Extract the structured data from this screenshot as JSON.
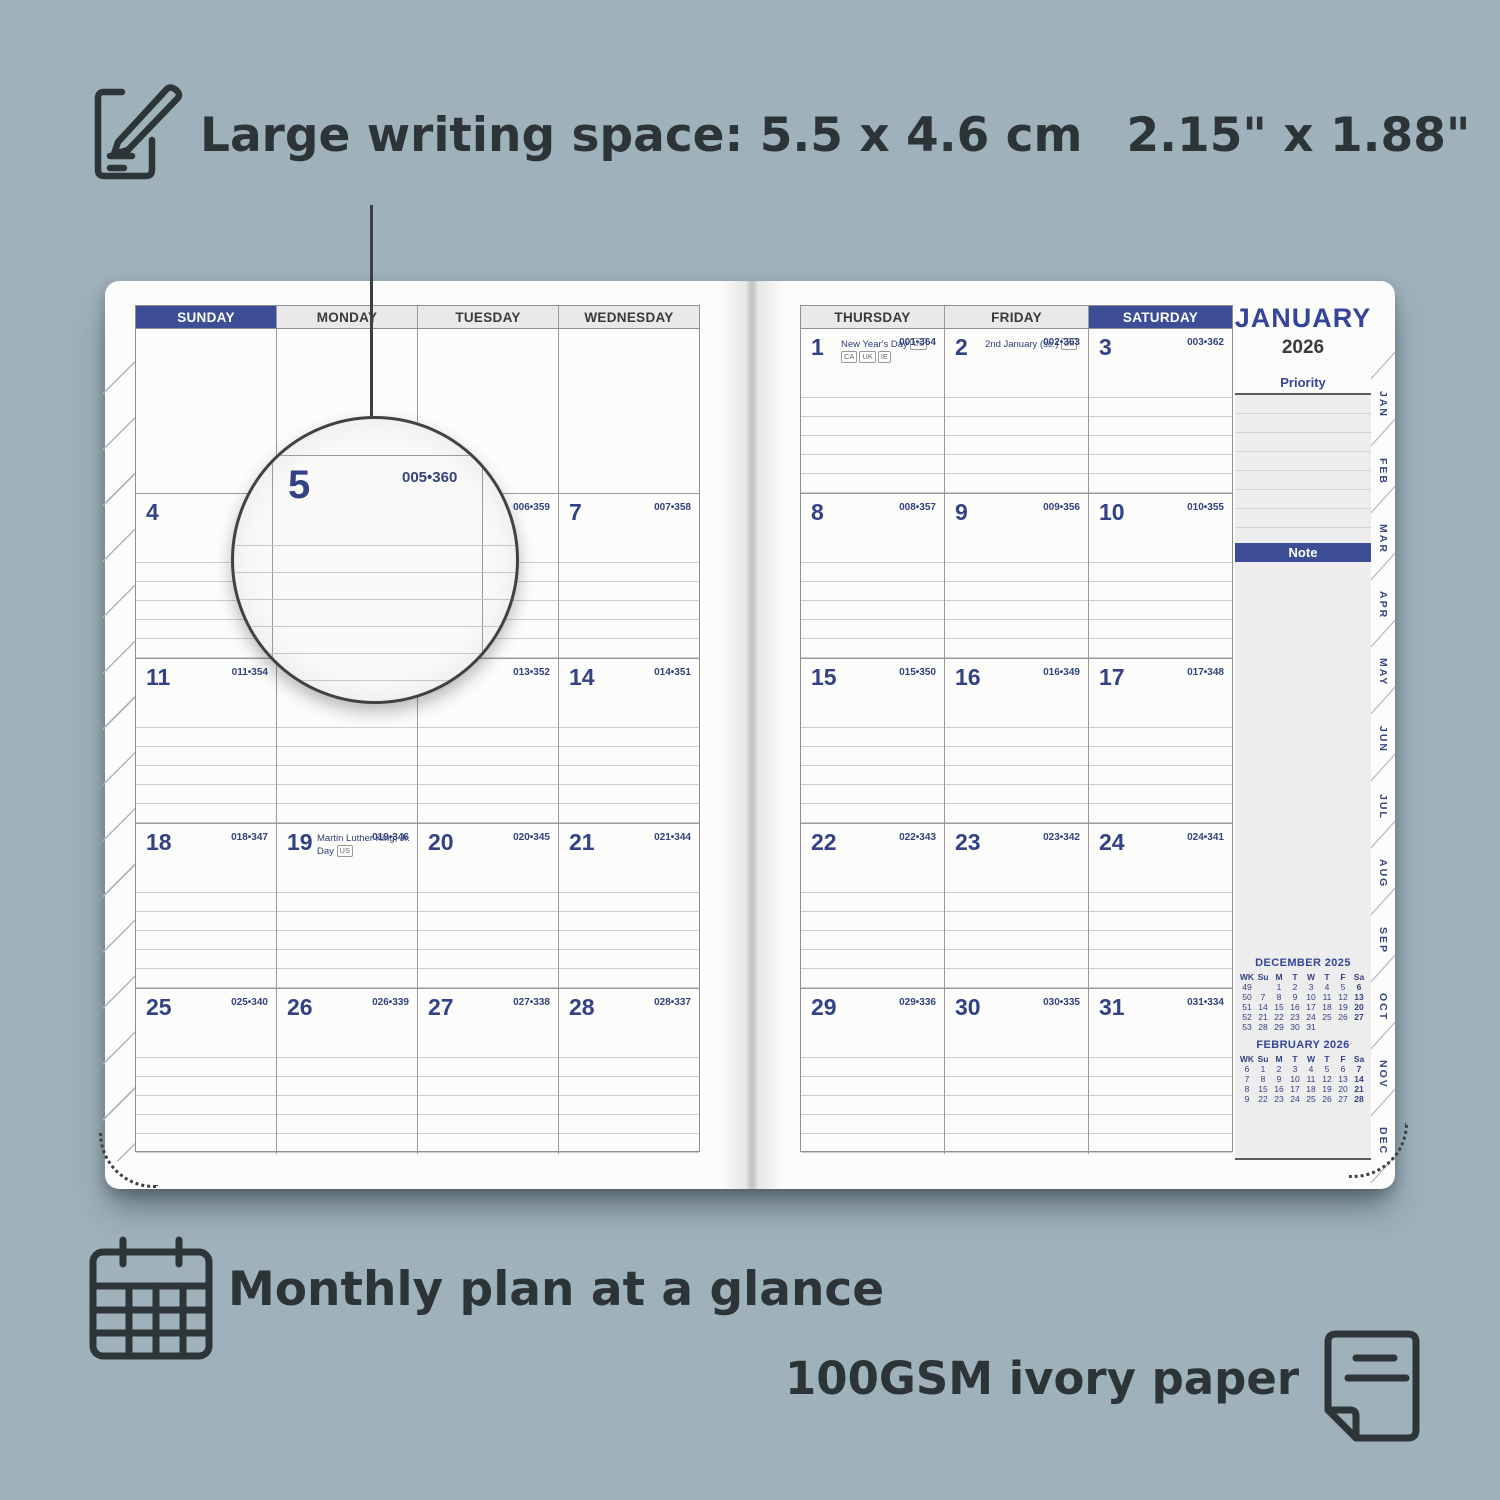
{
  "background_color": "#9fb1bb",
  "accent_navy": "#3d4e97",
  "callouts": {
    "writing_space": {
      "icon": "pencil-note-icon",
      "text_metric": "Large writing space: 5.5 x 4.6 cm",
      "text_imperial": "2.15\" x 1.88\""
    },
    "monthly_plan": {
      "icon": "calendar-grid-icon",
      "text": "Monthly plan at a glance"
    },
    "paper": {
      "icon": "paper-sheet-icon",
      "text": "100GSM ivory paper"
    }
  },
  "planner": {
    "month_title": "JANUARY",
    "year": "2026",
    "priority_label": "Priority",
    "note_label": "Note",
    "left_day_headers": [
      "SUNDAY",
      "MONDAY",
      "TUESDAY",
      "WEDNESDAY"
    ],
    "right_day_headers": [
      "THURSDAY",
      "FRIDAY",
      "SATURDAY"
    ],
    "left_highlight_index": 0,
    "right_highlight_index": 2,
    "left_weeks": [
      [
        {},
        {},
        {},
        {}
      ],
      [
        {
          "d": "4"
        },
        {},
        {
          "c": "006•359"
        },
        {
          "d": "7",
          "c": "007•358"
        }
      ],
      [
        {
          "d": "11",
          "c": "011•354"
        },
        {},
        {
          "c": "013•352"
        },
        {
          "d": "14",
          "c": "014•351"
        }
      ],
      [
        {
          "d": "18",
          "c": "018•347"
        },
        {
          "d": "19",
          "c": "019•346",
          "h": "Martin Luther King, Jr. Day",
          "f": [
            "US"
          ]
        },
        {
          "d": "20",
          "c": "020•345"
        },
        {
          "d": "21",
          "c": "021•344"
        }
      ],
      [
        {
          "d": "25",
          "c": "025•340"
        },
        {
          "d": "26",
          "c": "026•339"
        },
        {
          "d": "27",
          "c": "027•338"
        },
        {
          "d": "28",
          "c": "028•337"
        }
      ]
    ],
    "right_weeks": [
      [
        {
          "d": "1",
          "c": "001•364",
          "h": "New Year's Day",
          "f": [
            "US",
            "CA",
            "UK",
            "IE"
          ]
        },
        {
          "d": "2",
          "c": "002•363",
          "h": "2nd January (sc.)",
          "f": [
            "UK"
          ]
        },
        {
          "d": "3",
          "c": "003•362"
        }
      ],
      [
        {
          "d": "8",
          "c": "008•357"
        },
        {
          "d": "9",
          "c": "009•356"
        },
        {
          "d": "10",
          "c": "010•355"
        }
      ],
      [
        {
          "d": "15",
          "c": "015•350"
        },
        {
          "d": "16",
          "c": "016•349"
        },
        {
          "d": "17",
          "c": "017•348"
        }
      ],
      [
        {
          "d": "22",
          "c": "022•343"
        },
        {
          "d": "23",
          "c": "023•342"
        },
        {
          "d": "24",
          "c": "024•341"
        }
      ],
      [
        {
          "d": "29",
          "c": "029•336"
        },
        {
          "d": "30",
          "c": "030•335"
        },
        {
          "d": "31",
          "c": "031•334"
        }
      ]
    ],
    "magnifier": {
      "d": "5",
      "c": "005•360"
    },
    "tabs": [
      "JAN",
      "FEB",
      "MAR",
      "APR",
      "MAY",
      "JUN",
      "JUL",
      "AUG",
      "SEP",
      "OCT",
      "NOV",
      "DEC"
    ],
    "mini_calendars": [
      {
        "title": "DECEMBER  2025",
        "headers": [
          "WK",
          "Su",
          "M",
          "T",
          "W",
          "T",
          "F",
          "Sa"
        ],
        "rows": [
          [
            "49",
            "",
            "1",
            "2",
            "3",
            "4",
            "5",
            "6"
          ],
          [
            "50",
            "7",
            "8",
            "9",
            "10",
            "11",
            "12",
            "13"
          ],
          [
            "51",
            "14",
            "15",
            "16",
            "17",
            "18",
            "19",
            "20"
          ],
          [
            "52",
            "21",
            "22",
            "23",
            "24",
            "25",
            "26",
            "27"
          ],
          [
            "53",
            "28",
            "29",
            "30",
            "31",
            "",
            "",
            ""
          ]
        ]
      },
      {
        "title": "FEBRUARY  2026",
        "headers": [
          "WK",
          "Su",
          "M",
          "T",
          "W",
          "T",
          "F",
          "Sa"
        ],
        "rows": [
          [
            "6",
            "1",
            "2",
            "3",
            "4",
            "5",
            "6",
            "7"
          ],
          [
            "7",
            "8",
            "9",
            "10",
            "11",
            "12",
            "13",
            "14"
          ],
          [
            "8",
            "15",
            "16",
            "17",
            "18",
            "19",
            "20",
            "21"
          ],
          [
            "9",
            "22",
            "23",
            "24",
            "25",
            "26",
            "27",
            "28"
          ]
        ]
      }
    ]
  }
}
